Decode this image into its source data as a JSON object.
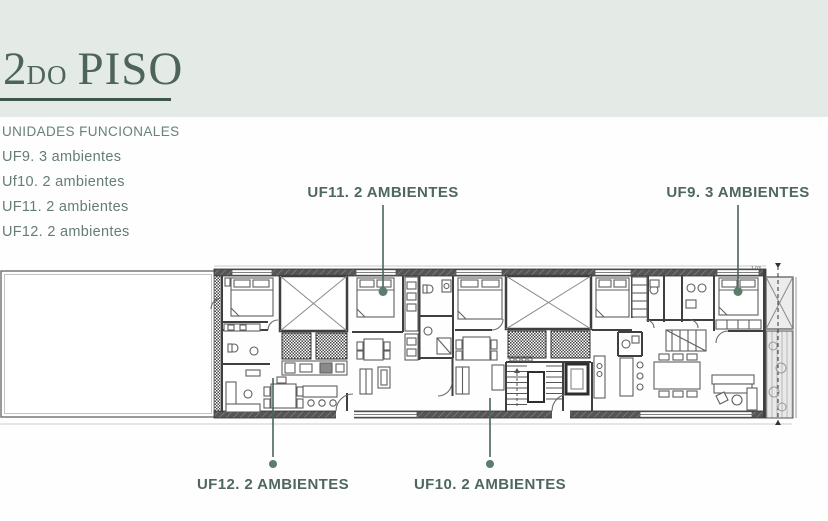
{
  "title": {
    "number": "2",
    "ordinal": "DO",
    "word": "PISO"
  },
  "units": {
    "heading": "UNIDADES FUNCIONALES",
    "items": [
      "UF9. 3 ambientes",
      "Uf10. 2 ambientes",
      "UF11. 2 ambientes",
      "UF12. 2 ambientes"
    ]
  },
  "callouts": {
    "uf11": "UF11. 2 AMBIENTES",
    "uf9": "UF9. 3 AMBIENTES",
    "uf12": "UF12. 2 AMBIENTES",
    "uf10": "UF10. 2 AMBIENTES"
  },
  "plan": {
    "annotation": "1.03"
  },
  "colors": {
    "band": "#e4eae5",
    "title": "#4d645a",
    "list_text": "#657d74",
    "callout_text": "#4f685d",
    "leader_line": "#4a665a",
    "unit_marker": "#5c7d6c",
    "wall": "#3f3f3f",
    "drawing_line": "#666666"
  }
}
